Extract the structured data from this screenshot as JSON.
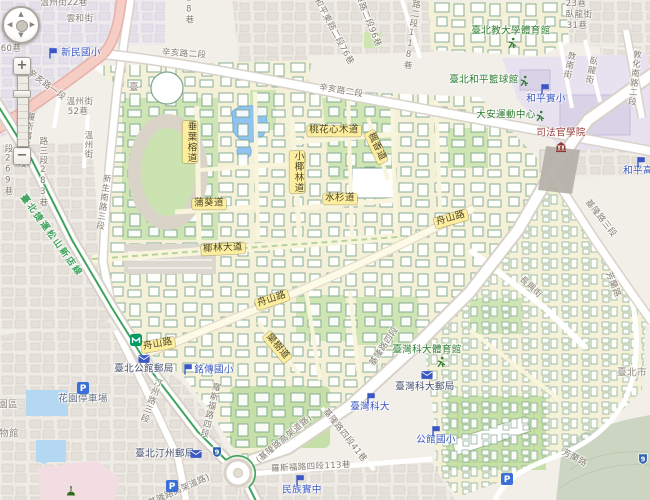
{
  "map": {
    "controls": {
      "zoom_in": "+",
      "zoom_out": "−",
      "pan_up": "▲",
      "pan_down": "▼",
      "pan_left": "◀",
      "pan_right": "▶"
    },
    "labels": [
      {
        "t": "溫州街22巷",
        "k": "st",
        "x": 64,
        "y": 4
      },
      {
        "t": "雲和街",
        "k": "st",
        "x": 80,
        "y": 20
      },
      {
        "t": "60巷",
        "k": "st",
        "x": 11,
        "y": 50
      },
      {
        "t": "辛亥路一段",
        "k": "st",
        "x": 46,
        "y": 86,
        "r": 37
      },
      {
        "t": "溫州街",
        "k": "st",
        "x": 80,
        "y": 103
      },
      {
        "t": "52巷",
        "k": "st",
        "x": 78,
        "y": 113
      },
      {
        "t": "羅斯福路三段",
        "k": "st",
        "x": 25,
        "y": 140,
        "v": 1,
        "r": 10
      },
      {
        "t": "段269巷",
        "k": "st",
        "x": 7,
        "y": 170,
        "v": 1
      },
      {
        "t": "路三段283巷",
        "k": "st",
        "x": 42,
        "y": 172,
        "v": 1
      },
      {
        "t": "溫州街",
        "k": "st",
        "x": 87,
        "y": 145,
        "v": 1
      },
      {
        "t": "新生南路三段",
        "k": "st",
        "x": 102,
        "y": 202,
        "v": 1,
        "r": 8
      },
      {
        "t": "18巷",
        "k": "st",
        "x": 188,
        "y": 9,
        "v": 1
      },
      {
        "t": "辛亥路二段",
        "k": "st",
        "x": 184,
        "y": 55,
        "r": 4
      },
      {
        "t": "和平東路二段76巷",
        "k": "st",
        "x": 333,
        "y": 32,
        "r": 62
      },
      {
        "t": "東路二段96巷",
        "k": "st",
        "x": 367,
        "y": 21,
        "r": 68
      },
      {
        "t": "東路二段118巷",
        "k": "st",
        "x": 411,
        "y": 30,
        "v": 1,
        "r": 8
      },
      {
        "t": "辛亥路二段",
        "k": "st",
        "x": 341,
        "y": 92,
        "r": 9
      },
      {
        "t": "23巷",
        "k": "st",
        "x": 576,
        "y": 5
      },
      {
        "t": "臥龍街",
        "k": "st",
        "x": 579,
        "y": 16
      },
      {
        "t": "31巷",
        "k": "st",
        "x": 577,
        "y": 27
      },
      {
        "t": "敦南街",
        "k": "st",
        "x": 568,
        "y": 65,
        "v": 1,
        "r": 12
      },
      {
        "t": "臥龍街",
        "k": "st",
        "x": 590,
        "y": 70,
        "v": 1,
        "r": 12
      },
      {
        "t": "敦化南路二段",
        "k": "st",
        "x": 633,
        "y": 78,
        "v": 1,
        "r": 6
      },
      {
        "t": "基隆路三段",
        "k": "st",
        "x": 600,
        "y": 219,
        "r": 52
      },
      {
        "t": "芳蘭路",
        "k": "st",
        "x": 612,
        "y": 285,
        "r": 68
      },
      {
        "t": "長興街",
        "k": "st",
        "x": 530,
        "y": 288,
        "r": 42
      },
      {
        "t": "基隆路四段",
        "k": "st",
        "x": 385,
        "y": 347,
        "r": -56
      },
      {
        "t": "(基隆路高架道路)",
        "k": "st",
        "x": 285,
        "y": 440,
        "r": -40
      },
      {
        "t": "(基隆路高架道路)",
        "k": "st",
        "x": 178,
        "y": 492,
        "r": -24
      },
      {
        "t": "基隆路四段41巷",
        "k": "st",
        "x": 344,
        "y": 436,
        "r": 52
      },
      {
        "t": "羅斯福路四段113巷",
        "k": "st",
        "x": 311,
        "y": 468,
        "r": -3
      },
      {
        "t": "羅斯福路四段",
        "k": "st",
        "x": 209,
        "y": 410,
        "v": 1,
        "r": 14
      },
      {
        "t": "汀州路三段",
        "k": "st",
        "x": 150,
        "y": 400,
        "v": 1,
        "r": 20
      },
      {
        "t": "芳蘭路",
        "k": "st",
        "x": 574,
        "y": 459,
        "r": 28
      },
      {
        "t": "舟山路",
        "k": "cr",
        "x": 451,
        "y": 219,
        "r": -16
      },
      {
        "t": "舟山路",
        "k": "cr",
        "x": 272,
        "y": 300,
        "r": -18
      },
      {
        "t": "舟山路",
        "k": "cr",
        "x": 158,
        "y": 345,
        "r": -10
      },
      {
        "t": "椰林大道",
        "k": "cr",
        "x": 223,
        "y": 249,
        "r": -3
      },
      {
        "t": "桃花心木道",
        "k": "cr",
        "x": 334,
        "y": 131
      },
      {
        "t": "楓香道",
        "k": "cr",
        "x": 376,
        "y": 147,
        "r": 65
      },
      {
        "t": "小椰林道",
        "k": "cr",
        "x": 297,
        "y": 172,
        "v": 1
      },
      {
        "t": "垂葉榕道",
        "k": "cr",
        "x": 190,
        "y": 142,
        "v": 1
      },
      {
        "t": "水杉道",
        "k": "cr",
        "x": 340,
        "y": 199
      },
      {
        "t": "蒲葵道",
        "k": "cr",
        "x": 209,
        "y": 204
      },
      {
        "t": "欒樹道",
        "k": "cr",
        "x": 277,
        "y": 347,
        "r": 50
      },
      {
        "t": "臺北捷運松山新店線",
        "k": "tr",
        "x": 51,
        "y": 236,
        "r": 54
      },
      {
        "t": "新民國小",
        "k": "sc",
        "x": 81,
        "y": 54
      },
      {
        "t": "和平實小",
        "k": "sc",
        "x": 546,
        "y": 100
      },
      {
        "t": "和平高",
        "k": "sc",
        "x": 638,
        "y": 172
      },
      {
        "t": "銘傳國小",
        "k": "sc",
        "x": 214,
        "y": 371
      },
      {
        "t": "臺灣科大",
        "k": "sc",
        "x": 370,
        "y": 408
      },
      {
        "t": "公館國小",
        "k": "sc",
        "x": 436,
        "y": 441
      },
      {
        "t": "民族實中",
        "k": "sc",
        "x": 302,
        "y": 491
      },
      {
        "t": "臺北教大學體育館",
        "k": "sp",
        "x": 511,
        "y": 32
      },
      {
        "t": "臺北和平籃球館",
        "k": "sp",
        "x": 484,
        "y": 81
      },
      {
        "t": "大安運動中心",
        "k": "sp",
        "x": 506,
        "y": 116
      },
      {
        "t": "臺灣科大體育館",
        "k": "sp",
        "x": 427,
        "y": 351
      },
      {
        "t": "司法官學院",
        "k": "gv",
        "x": 561,
        "y": 134
      },
      {
        "t": "臺北公館郵局",
        "k": "po",
        "x": 144,
        "y": 370
      },
      {
        "t": "臺北汀州郵局",
        "k": "po",
        "x": 165,
        "y": 455
      },
      {
        "t": "臺灣科大郵局",
        "k": "po",
        "x": 425,
        "y": 388
      },
      {
        "t": "花園停車場",
        "k": "pk",
        "x": 83,
        "y": 400
      },
      {
        "t": "園區",
        "k": "gn",
        "x": 8,
        "y": 406
      },
      {
        "t": "物館",
        "k": "gn",
        "x": 9,
        "y": 435
      },
      {
        "t": "臺北市",
        "k": "gn",
        "x": 632,
        "y": 374
      },
      {
        "t": "臺",
        "k": "gn",
        "x": 134,
        "y": 89
      }
    ],
    "icons": [
      {
        "i": "school",
        "x": 53,
        "y": 53
      },
      {
        "i": "school",
        "x": 545,
        "y": 89
      },
      {
        "i": "school",
        "x": 641,
        "y": 162
      },
      {
        "i": "school",
        "x": 188,
        "y": 369
      },
      {
        "i": "school",
        "x": 371,
        "y": 398
      },
      {
        "i": "school",
        "x": 436,
        "y": 431
      },
      {
        "i": "school",
        "x": 300,
        "y": 480
      },
      {
        "i": "sport",
        "x": 512,
        "y": 43
      },
      {
        "i": "sport",
        "x": 524,
        "y": 81
      },
      {
        "i": "sport",
        "x": 540,
        "y": 116
      },
      {
        "i": "sport",
        "x": 441,
        "y": 362
      },
      {
        "i": "gov",
        "x": 561,
        "y": 147
      },
      {
        "i": "post",
        "x": 144,
        "y": 359
      },
      {
        "i": "post",
        "x": 196,
        "y": 454
      },
      {
        "i": "post",
        "x": 427,
        "y": 375
      },
      {
        "i": "parking",
        "x": 83,
        "y": 388
      },
      {
        "i": "parking",
        "x": 172,
        "y": 486
      },
      {
        "i": "parking",
        "x": 507,
        "y": 479
      },
      {
        "i": "metro",
        "x": 136,
        "y": 340
      },
      {
        "i": "shield",
        "t": "9",
        "x": 217,
        "y": 452
      },
      {
        "i": "shield",
        "t": "9",
        "x": 643,
        "y": 459
      },
      {
        "i": "dome",
        "x": 71,
        "y": 491
      }
    ]
  },
  "colors": {
    "campus_fill": "#f5f1d8",
    "water_blue": "#8fc3f0",
    "park_green": "#cfe5b4",
    "arterial_pink": "#f6cdc4",
    "metro_green": "#3fa35c",
    "campus_road_label_bg": "#fcee9e",
    "school_blue": "#3a57c4",
    "sport_green": "#2e7d32",
    "gov_red": "#953735",
    "parking_blue": "#3a6fd8",
    "shield_blue": "#2f63ad",
    "metro_icon_green": "#009a63"
  }
}
